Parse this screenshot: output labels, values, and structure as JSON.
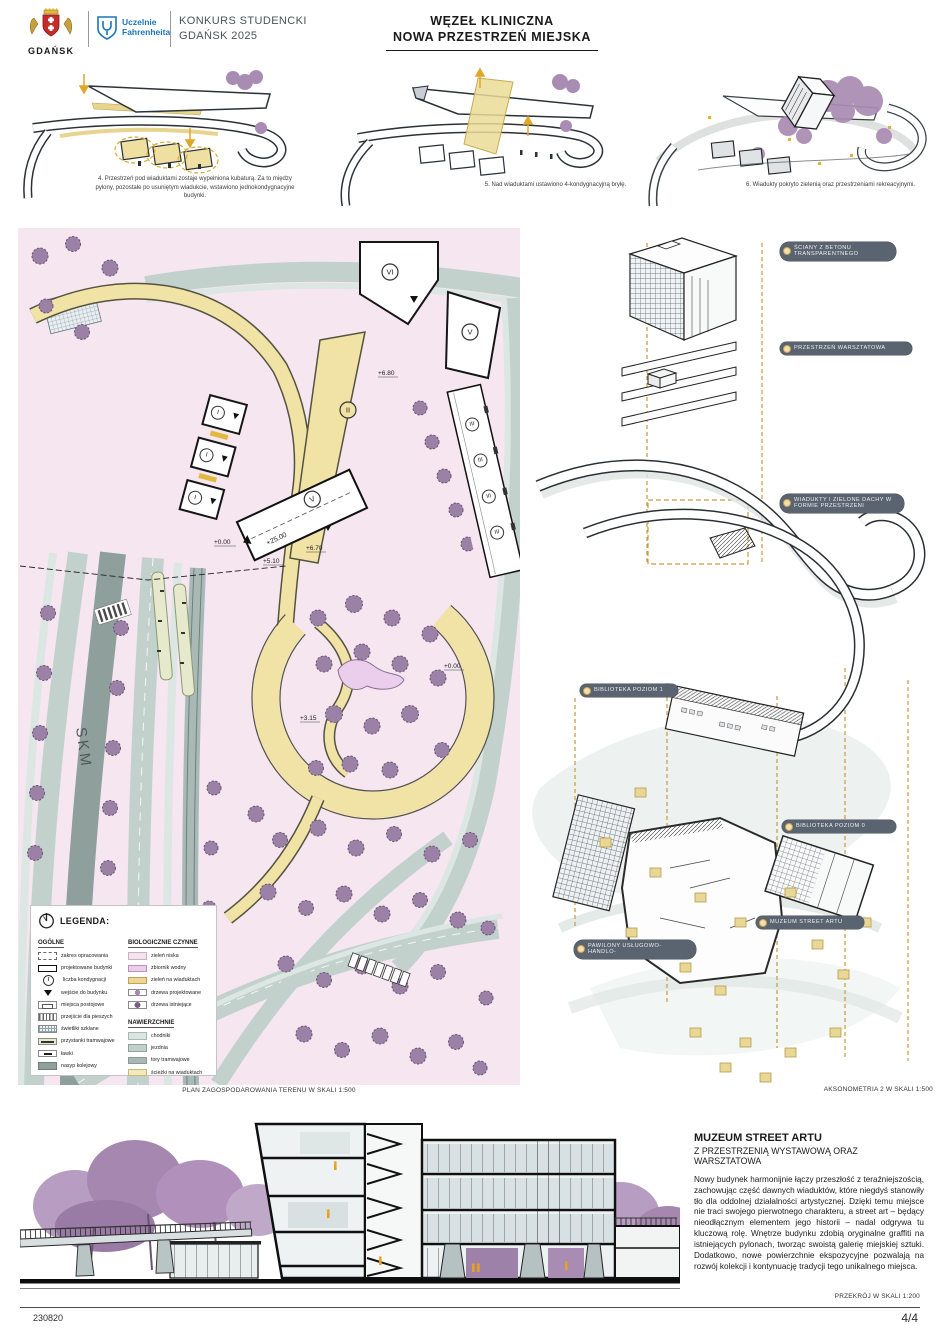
{
  "header": {
    "city_logo": {
      "name": "GDAŃSK"
    },
    "uf_logo": {
      "line1": "Uczelnie",
      "line2": "Fahrenheita"
    },
    "competition": {
      "line1": "KONKURS STUDENCKI",
      "line2": "GDAŃSK 2025"
    },
    "title": {
      "line1": "WĘZEŁ KLINICZNA",
      "line2": "NOWA PRZESTRZEŃ MIEJSKA"
    }
  },
  "diagrams": [
    {
      "caption": "4. Przestrzeń pod wiaduktami zostaje wypełniona kubaturą. Za to między pylony, pozostałe po usuniętym wiadukcie, wstawiono jednokondygnacyjne budynki."
    },
    {
      "caption": "5. Nad wiaduktami ustawiono 4-kondygnacyjną bryłę."
    },
    {
      "caption": "6. Wiadukty pokryto zielenią oraz przestrzeniami rekreacyjnymi."
    }
  ],
  "site_plan": {
    "caption": "PLAN ZAGOSPODAROWANIA TERENU W SKALI 1:500",
    "skm_label": "SKM",
    "levels": {
      "l25": "+25.00",
      "l00a": "+0.00",
      "l510": "+5.10",
      "l670": "+6.70",
      "l680": "+6.80",
      "l315": "+3.15",
      "l00b": "+0.00"
    },
    "storeys": {
      "i": "I",
      "ii": "II",
      "iii": "III",
      "v": "V",
      "vi": "VI"
    }
  },
  "legend": {
    "title": "LEGENDA:",
    "icons": {
      "floors_glyph": "I"
    },
    "groups": {
      "general": {
        "title": "OGÓLNE",
        "items": [
          "zakres opracowania",
          "projektowane budynki",
          "liczba kondygnacji",
          "wejście do budynku",
          "miejsca postojowe",
          "przejście dla pieszych",
          "świetliki szklane",
          "przystanki tramwajowe",
          "ławki",
          "nasyp kolejowy"
        ]
      },
      "bio": {
        "title": "BIOLOGICZNIE CZYNNE",
        "items": [
          "zieleń niska",
          "zbiornik wodny",
          "zieleń na wiaduktach",
          "drzewa projektowane",
          "drzewa istniejące"
        ]
      },
      "surfaces": {
        "title": "NAWIERZCHNIE",
        "items": [
          "chodniki",
          "jezdnia",
          "tory tramwajowe",
          "ścieżki na wiaduktach"
        ]
      }
    }
  },
  "axonometry": {
    "caption": "AKSONOMETRIA 2 W SKALI 1:500",
    "labels": [
      "ŚCIANY Z BETONU TRANSPARENTNEGO",
      "PRZESTRZEŃ WARSZTATOWA",
      "WIADUKTY I ZIELONE DACHY W FORMIE PRZESTRZENI",
      "BIBLIOTEKA POZIOM 1",
      "BIBLIOTEKA POZIOM 0",
      "MUZEUM STREET ARTU",
      "PAWILONY USŁUGOWO-HANDLO-"
    ]
  },
  "section": {
    "title": "MUZEUM STREET ARTU",
    "subtitle": "Z PRZESTRZENIĄ WYSTAWOWĄ ORAZ WARSZTATOWA",
    "body": "Nowy budynek harmonijnie łączy przeszłość z teraźniejszością, zachowując część dawnych wiaduktów, które niegdyś stanowiły tło dla oddolnej działalności artystycznej. Dzięki temu miejsce nie traci swojego pierwotnego charakteru, a street art – będący nieodłącznym elementem jego historii – nadal odgrywa tu kluczową rolę. Wnętrze budynku zdobią oryginalne graffiti na istniejących pylonach, tworząc swoistą galerię miejskiej sztuki. Dodatkowo, nowe powierzchnie ekspozycyjne pozwalają na rozwój kolekcji i kontynuację tradycji tego unikalnego miejsca.",
    "caption": "PRZEKRÓJ W SKALI 1:200"
  },
  "footer": {
    "code": "230820",
    "page": "4/4"
  },
  "colors": {
    "green_low": "#f5e6f0",
    "water": "#eaceec",
    "green_viaduct": "#ecd794",
    "tree": "#9c81a7",
    "walkway": "#dce6e2",
    "road": "#c3d1cd",
    "tram": "#a9bab6",
    "viaduct_path": "#f1e2a6",
    "embankment": "#8e9f9c",
    "accent_gold": "#c79a3c",
    "label_pill": "#5a6470",
    "uf_blue": "#1b75bb",
    "crest_red": "#c62b2b"
  }
}
